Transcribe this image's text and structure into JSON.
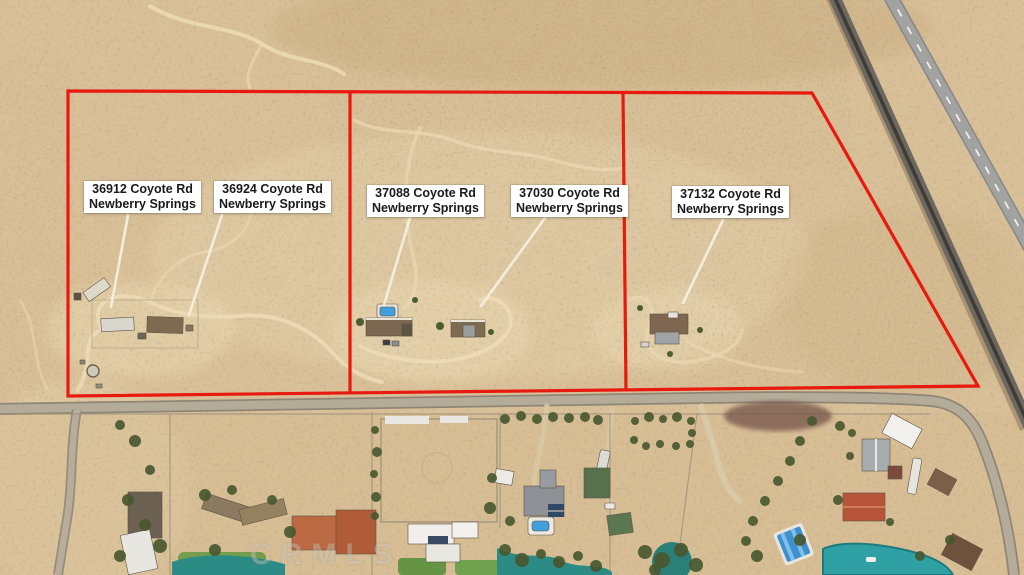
{
  "parcel_labels": [
    {
      "address": "36912 Coyote Rd",
      "city": "Newberry Springs"
    },
    {
      "address": "36924 Coyote Rd",
      "city": "Newberry Springs"
    },
    {
      "address": "37088 Coyote Rd",
      "city": "Newberry Springs"
    },
    {
      "address": "37030 Coyote Rd",
      "city": "Newberry Springs"
    },
    {
      "address": "37132 Coyote Rd",
      "city": "Newberry Springs"
    }
  ],
  "watermark": "CRMLS",
  "colors": {
    "boundary_red": "#e8190f",
    "leader_line": "#f7efdf",
    "label_bg": "#ffffff",
    "label_text": "#1a1a1a",
    "desert_sand": "#d8bf97",
    "road_gray": "#b5ab99",
    "lake_teal": "#2fa0a4",
    "pond_green": "#2c8b84",
    "pool_blue": "#41a0dc"
  }
}
